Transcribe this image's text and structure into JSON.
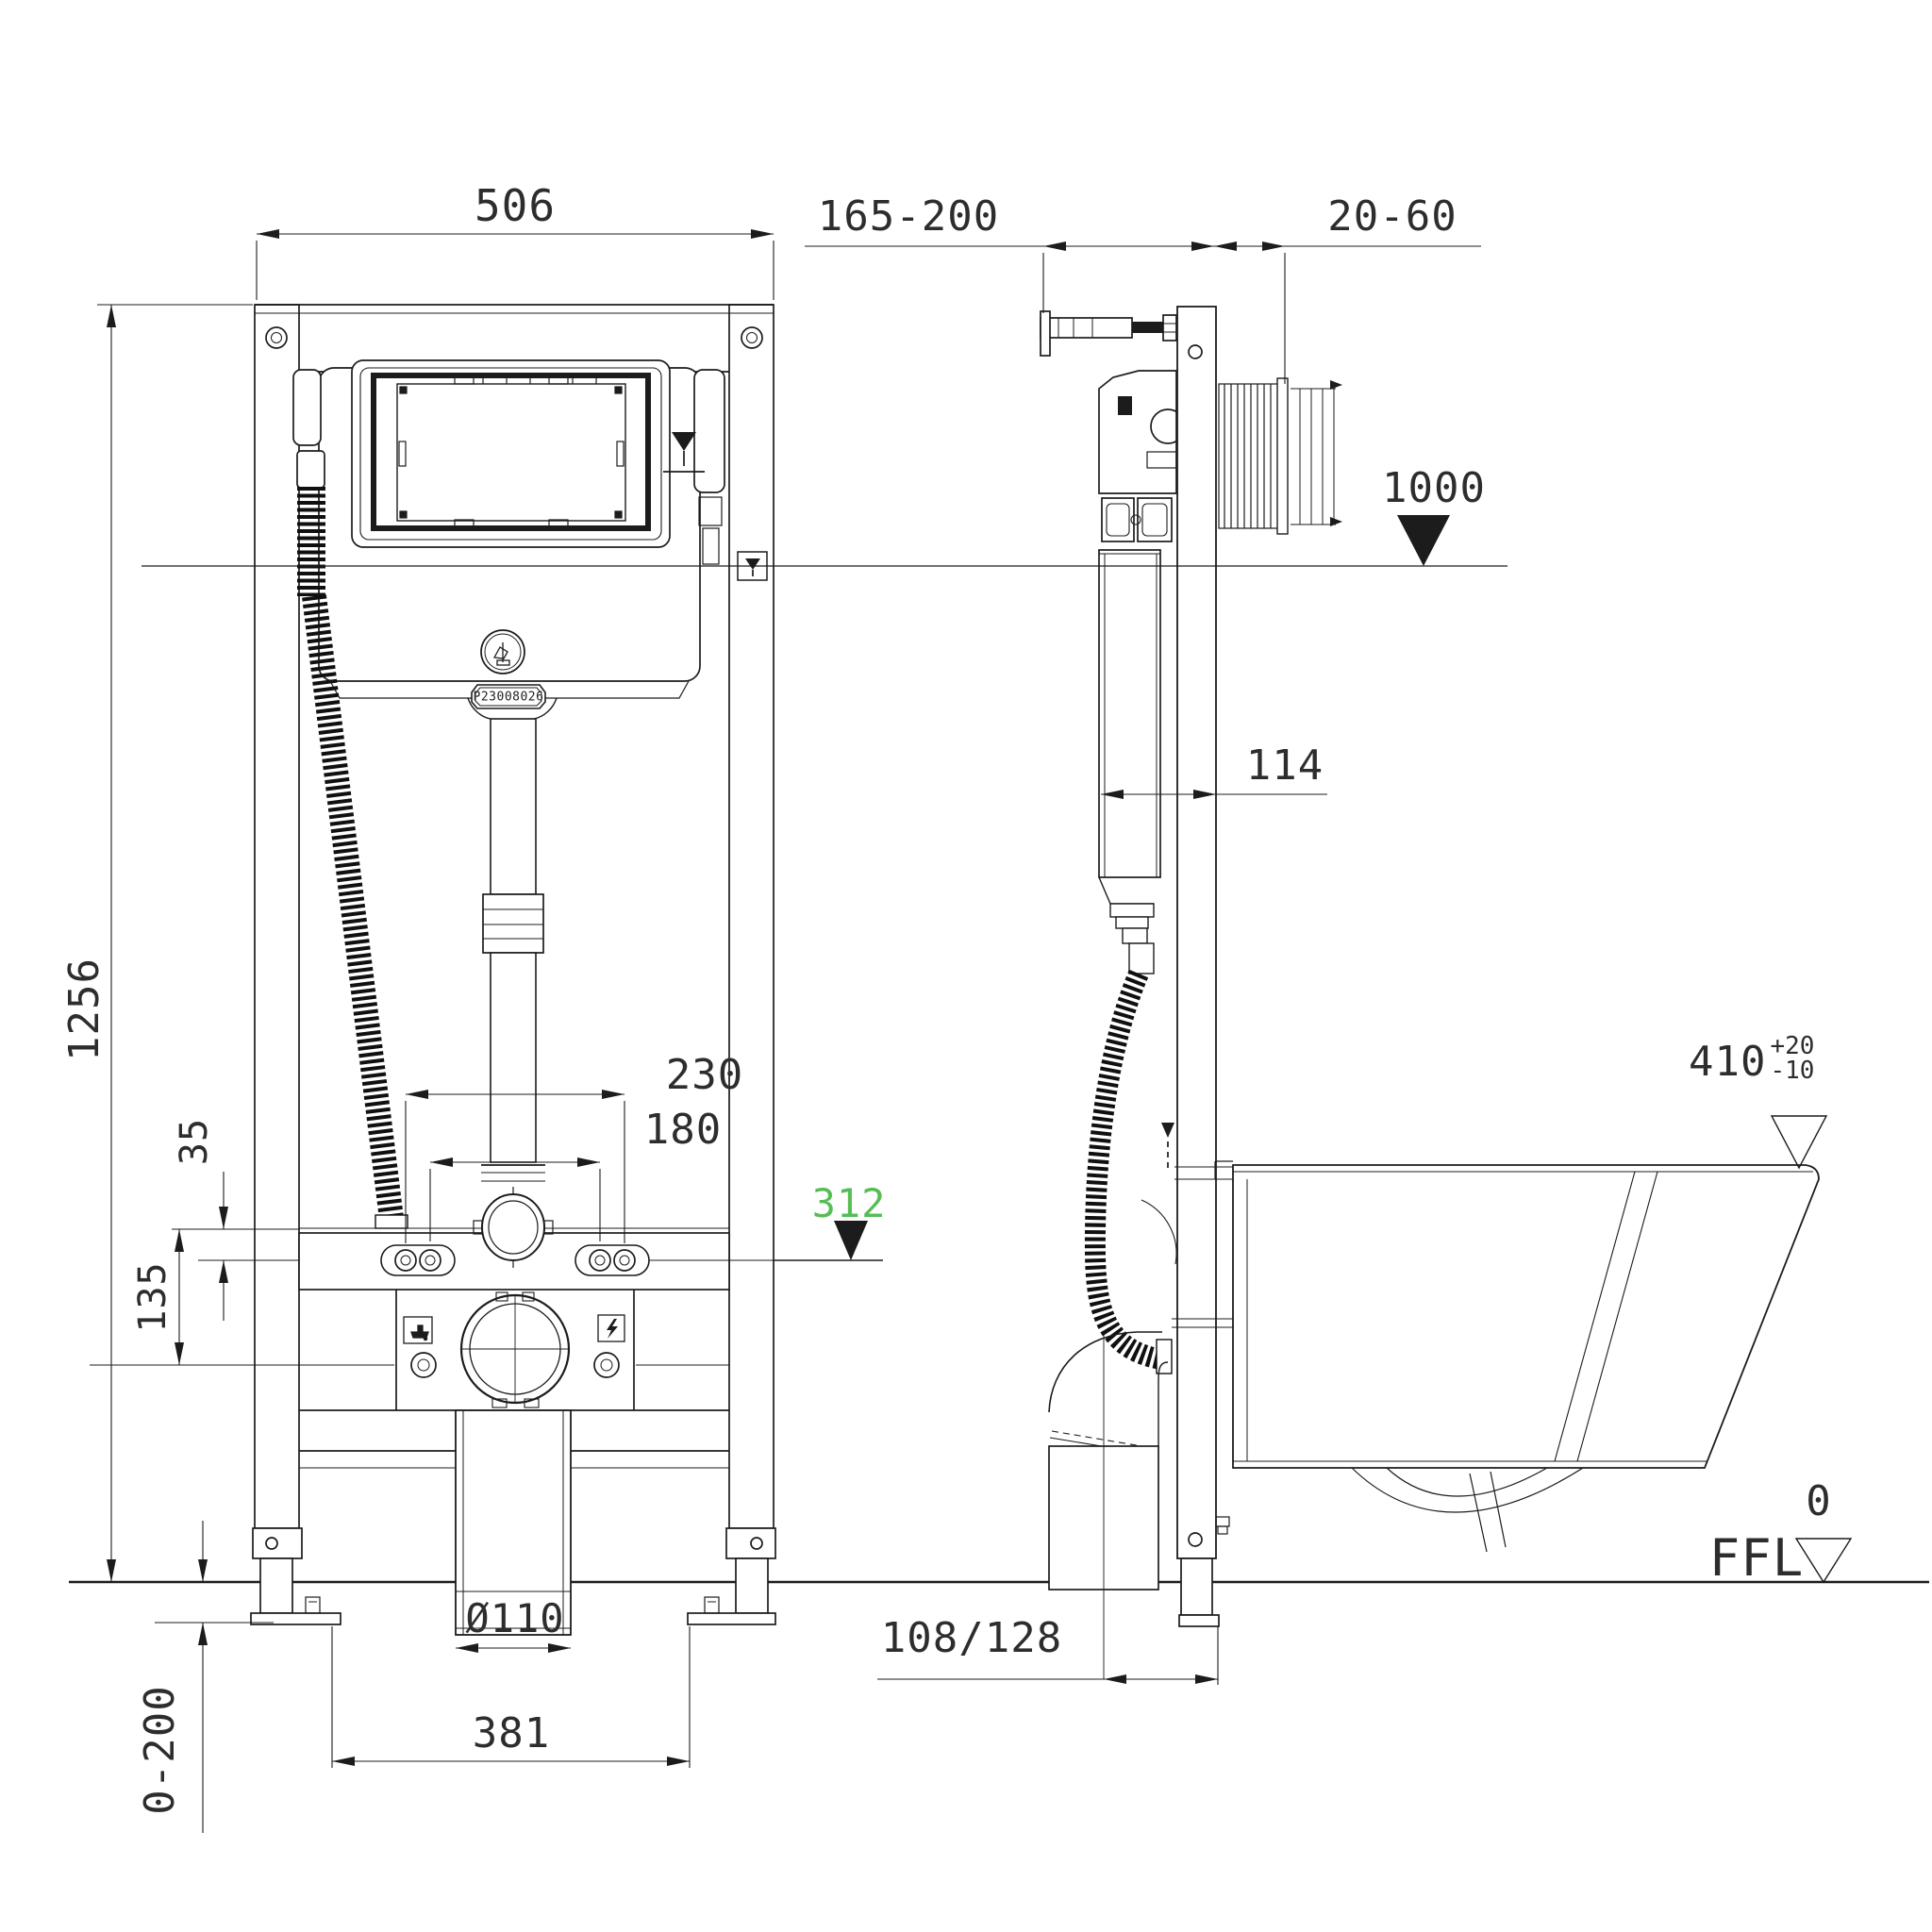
{
  "drawing": {
    "type": "installation-dimension-drawing",
    "subject": "concealed cistern frame for wall-hung WC, front and side view",
    "units": "mm",
    "line_color": "#1c1c1c",
    "accent_green": "#56bd56"
  },
  "labels": {
    "dim_frame_width": "506",
    "dim_frame_height": "1256",
    "dim_wall_depth_range": "165-200",
    "dim_lining_range": "20-60",
    "level_flush_plate": "1000",
    "dim_frame_depth": "114",
    "dim_outlet_230": "230",
    "dim_outlet_180": "180",
    "dim_35": "35",
    "dim_135": "135",
    "level_outlet": "312",
    "dim_bowl_height": "410",
    "tol_plus": "+20",
    "tol_minus": "-10",
    "ffl_zero": "0",
    "ffl": "FFL",
    "dim_foot_range": "0-200",
    "dim_foot_span": "381",
    "dim_drain_diameter": "Ø110",
    "dim_outlet_depth": "108/128",
    "serial": "P23008026"
  }
}
